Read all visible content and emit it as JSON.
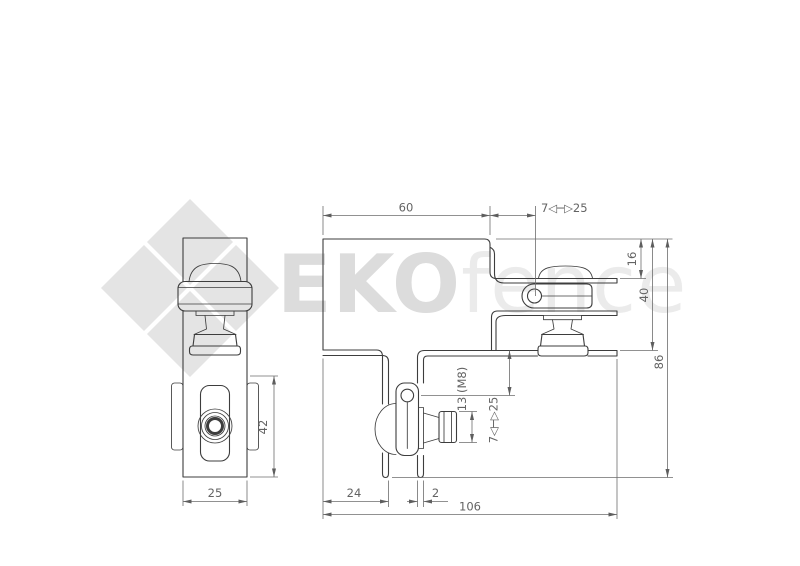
{
  "watermark": {
    "brand_bold": "EKO",
    "brand_light": "fence"
  },
  "colors": {
    "part_line": "#3d3d3d",
    "dimension_line": "#6e6e6e",
    "watermark_gray": "#e4e4e4"
  },
  "dimensions": {
    "front_top_width": "60",
    "front_top_range": "7◁─▷25",
    "front_offset_top": "16",
    "front_upper_height": "40",
    "front_total_height": "86",
    "front_leg_offset": "24",
    "front_sheet_thickness": "2",
    "front_total_width": "106",
    "front_nut_size": "13 (M8)",
    "front_lower_range": "7◁─▷25",
    "side_body_height": "42",
    "side_width": "25"
  }
}
